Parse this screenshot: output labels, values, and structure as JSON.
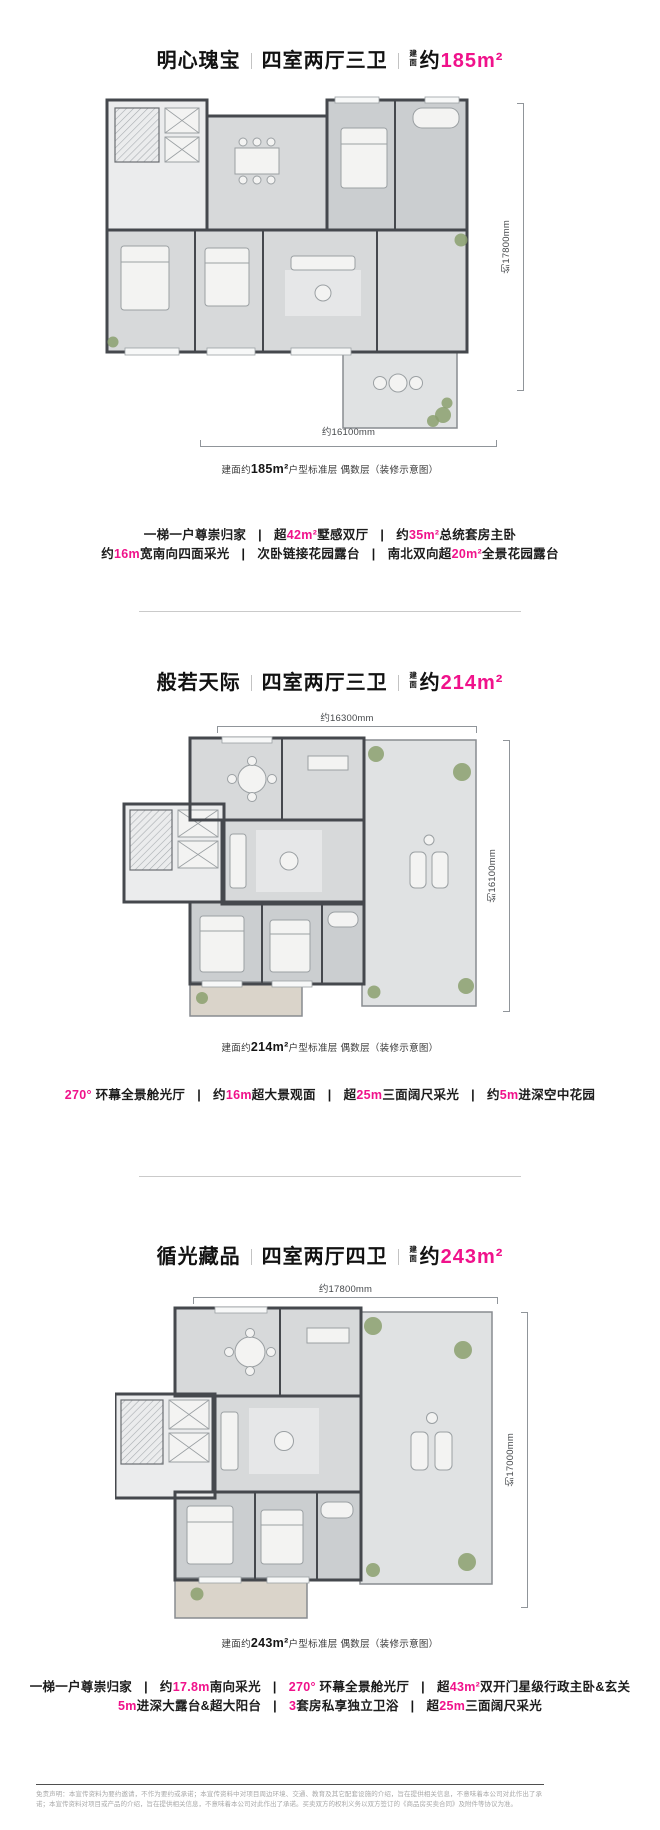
{
  "accent": "#f0128b",
  "sections": [
    {
      "title": {
        "name": "明心瑰宝",
        "rooms": "四室两厅三卫",
        "area_label": "建面",
        "approx": "约",
        "area": "185m²"
      },
      "plan": {
        "dim_bottom": "约16100mm",
        "dim_right": "约17800mm"
      },
      "caption": {
        "pre": "建面约",
        "area": "185m²",
        "post": "户型标准层 偶数层（装修示意图）"
      },
      "features": [
        [
          {
            "t": "一梯一户尊崇归家"
          },
          {
            "t": "|",
            "s": "sep"
          },
          {
            "t": "超"
          },
          {
            "t": "42m²",
            "s": "hl"
          },
          {
            "t": "墅感双厅"
          },
          {
            "t": "|",
            "s": "sep"
          },
          {
            "t": "约"
          },
          {
            "t": "35m²",
            "s": "hl"
          },
          {
            "t": "总统套房主卧"
          }
        ],
        [
          {
            "t": "约"
          },
          {
            "t": "16m",
            "s": "hl"
          },
          {
            "t": "宽南向四面采光"
          },
          {
            "t": "|",
            "s": "sep"
          },
          {
            "t": "次卧链接花园露台"
          },
          {
            "t": "|",
            "s": "sep"
          },
          {
            "t": "南北双向超"
          },
          {
            "t": "20m²",
            "s": "hl"
          },
          {
            "t": "全景花园露台"
          }
        ]
      ]
    },
    {
      "title": {
        "name": "般若天际",
        "rooms": "四室两厅三卫",
        "area_label": "建面",
        "approx": "约",
        "area": "214m²"
      },
      "plan": {
        "dim_top": "约16300mm",
        "dim_right": "约16100mm"
      },
      "caption": {
        "pre": "建面约",
        "area": "214m²",
        "post": "户型标准层 偶数层（装修示意图）"
      },
      "features": [
        [
          {
            "t": "270°",
            "s": "hl"
          },
          {
            "t": " 环幕全景舱光厅"
          },
          {
            "t": "|",
            "s": "sep"
          },
          {
            "t": "约"
          },
          {
            "t": "16m",
            "s": "hl"
          },
          {
            "t": "超大景观面"
          },
          {
            "t": "|",
            "s": "sep"
          },
          {
            "t": "超"
          },
          {
            "t": "25m",
            "s": "hl"
          },
          {
            "t": "三面阔尺采光"
          },
          {
            "t": "|",
            "s": "sep"
          },
          {
            "t": "约"
          },
          {
            "t": "5m",
            "s": "hl"
          },
          {
            "t": "进深空中花园"
          }
        ]
      ]
    },
    {
      "title": {
        "name": "循光藏品",
        "rooms": "四室两厅四卫",
        "area_label": "建面",
        "approx": "约",
        "area": "243m²"
      },
      "plan": {
        "dim_top": "约17800mm",
        "dim_right": "约17000mm"
      },
      "caption": {
        "pre": "建面约",
        "area": "243m²",
        "post": "户型标准层 偶数层（装修示意图）"
      },
      "features": [
        [
          {
            "t": "一梯一户尊崇归家"
          },
          {
            "t": "|",
            "s": "sep"
          },
          {
            "t": "约"
          },
          {
            "t": "17.8m",
            "s": "hl"
          },
          {
            "t": "南向采光"
          },
          {
            "t": "|",
            "s": "sep"
          },
          {
            "t": "270°",
            "s": "hl"
          },
          {
            "t": " 环幕全景舱光厅"
          },
          {
            "t": "|",
            "s": "sep"
          },
          {
            "t": "超"
          },
          {
            "t": "43m²",
            "s": "hl"
          },
          {
            "t": "双开门星级行政主卧&玄关"
          }
        ],
        [
          {
            "t": "5m",
            "s": "hl"
          },
          {
            "t": "进深大露台&超大阳台"
          },
          {
            "t": "|",
            "s": "sep"
          },
          {
            "t": "3",
            "s": "hl"
          },
          {
            "t": "套房私享独立卫浴"
          },
          {
            "t": "|",
            "s": "sep"
          },
          {
            "t": "超"
          },
          {
            "t": "25m",
            "s": "hl"
          },
          {
            "t": "三面阔尺采光"
          }
        ]
      ]
    }
  ],
  "disclaimer": "免责声明：本宣传资料为要约邀请，不作为要约或承诺；本宣传资料中对项目周边环境、交通、教育及其它配套设施的介绍，旨在提供相关信息，不意味着本公司对此作出了承诺；本宣传资料对项目或产品的介绍，旨在提供相关信息，不意味着本公司对此作出了承诺。买卖双方的权利义务以双方签订的《商品房买卖合同》及附件等协议为准。"
}
